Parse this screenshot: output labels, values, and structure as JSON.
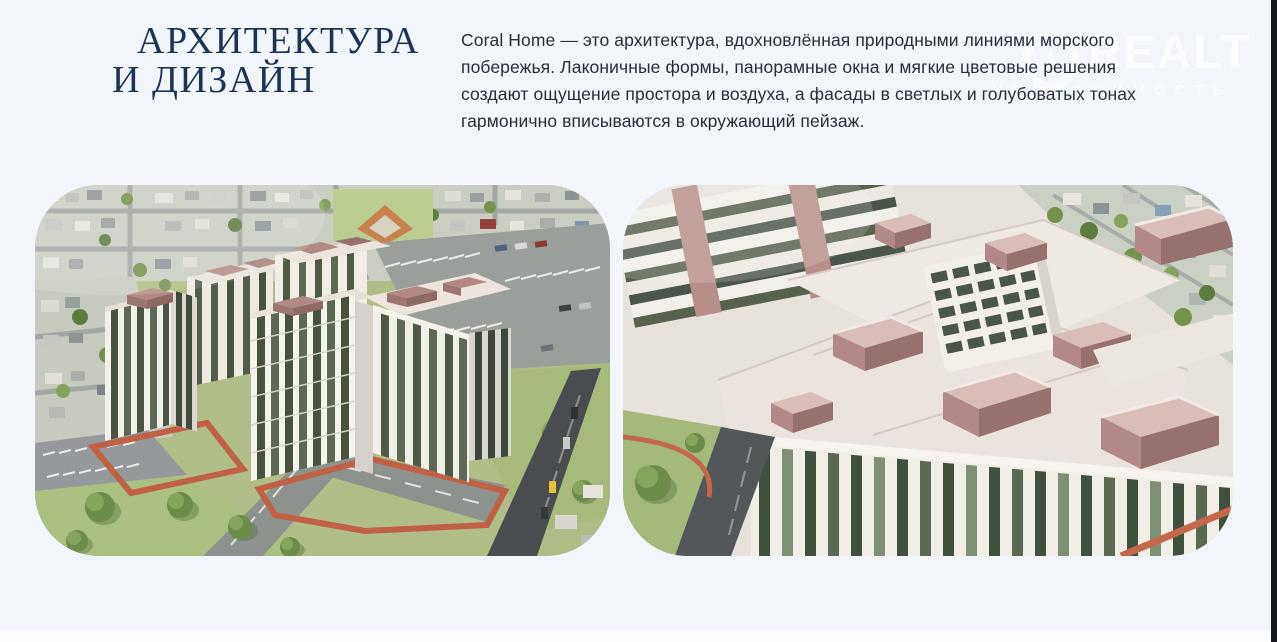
{
  "page": {
    "background_color": "#f2f6fa",
    "edge_bar_color": "#16191e",
    "bottom_strip_color": "#fbfdff"
  },
  "section": {
    "title": {
      "lines": [
        "АРХИТЕКТУРА",
        "И ДИЗАЙН"
      ],
      "color": "#1d3356"
    },
    "paragraph": {
      "color": "#272d39",
      "lines": [
        "Coral Home — это архитектура, вдохновлённая природными линиями морского",
        "побережья. Лаконичные формы, панорамные окна и мягкие цветовые решения",
        "создают ощущение простора и воздуха, а фасады в светлых и голубоватых тонах",
        "гармонично вписываются в окружающий пейзаж."
      ]
    }
  },
  "watermark": {
    "brand": "REALT",
    "subtitle": "НЕДВИЖИМОСТЬ",
    "icon": "realt-ring-logo",
    "color": "#ffffff"
  },
  "gallery": {
    "accent_path_color": "#c06044",
    "brick_color": "#b2888a",
    "facade_color": "#f3f1eb",
    "glass_color": "#46513f",
    "grass_color": "#abbf80"
  }
}
